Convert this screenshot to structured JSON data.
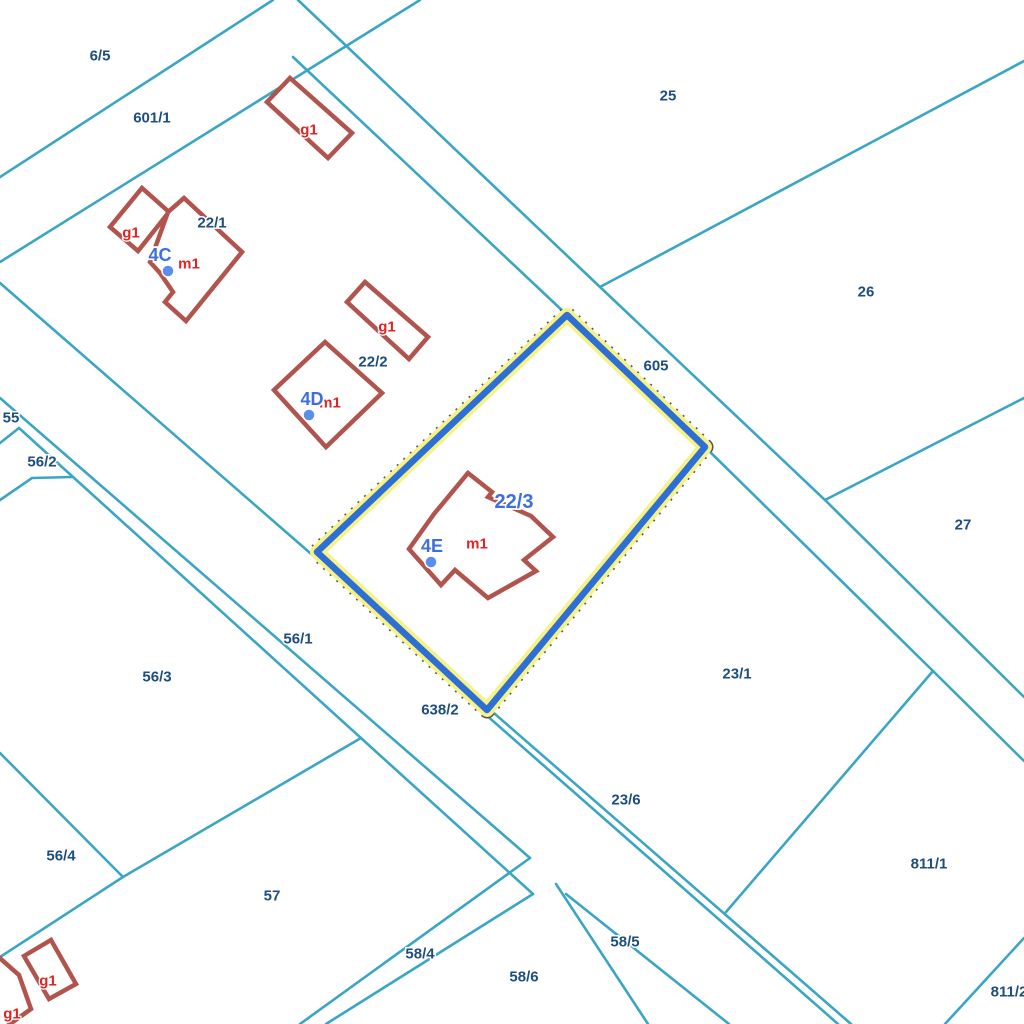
{
  "map": {
    "background": "#ffffff",
    "colors": {
      "parcel_line": "#3ba6c4",
      "building_stroke": "#b2544e",
      "building_fill": "#ffffff",
      "label_navy": "#1d4e7e",
      "label_red": "#e02424",
      "label_blue": "#3f6fdd",
      "highlight_blue": "#2e6fd6",
      "highlight_halo": "#f7f287",
      "highlight_dash": "#555555",
      "address_dot": "#5b8cf0"
    },
    "highlight": {
      "parcel_id": "22/3",
      "points": [
        [
          567,
          315
        ],
        [
          705,
          447
        ],
        [
          487,
          710
        ],
        [
          317,
          552
        ]
      ]
    },
    "boundary_lines": [
      {
        "id": "l1",
        "points": [
          [
            0,
            177
          ],
          [
            273,
            0
          ]
        ]
      },
      {
        "id": "l2",
        "points": [
          [
            0,
            262
          ],
          [
            420,
            0
          ]
        ]
      },
      {
        "id": "l3",
        "points": [
          [
            0,
            283
          ],
          [
            851,
            1024
          ]
        ]
      },
      {
        "id": "r1",
        "points": [
          [
            293,
            57
          ],
          [
            567,
            315
          ],
          [
            705,
            447
          ],
          [
            933,
            671
          ],
          [
            1024,
            761
          ]
        ]
      },
      {
        "id": "r2",
        "points": [
          [
            298,
            0
          ],
          [
            600,
            287
          ],
          [
            825,
            500
          ],
          [
            1024,
            697
          ]
        ]
      },
      {
        "id": "t25",
        "points": [
          [
            600,
            287
          ],
          [
            1024,
            61
          ]
        ]
      },
      {
        "id": "t26",
        "points": [
          [
            825,
            500
          ],
          [
            1024,
            398
          ]
        ]
      },
      {
        "id": "t23",
        "points": [
          [
            933,
            671
          ],
          [
            726,
            912
          ]
        ]
      },
      {
        "id": "t811",
        "points": [
          [
            1024,
            938
          ],
          [
            945,
            1024
          ]
        ]
      },
      {
        "id": "w1",
        "points": [
          [
            0,
            398
          ],
          [
            530,
            858
          ]
        ]
      },
      {
        "id": "w2",
        "points": [
          [
            19,
            428
          ],
          [
            533,
            894
          ]
        ]
      },
      {
        "id": "b55",
        "points": [
          [
            0,
            443
          ],
          [
            19,
            428
          ]
        ]
      },
      {
        "id": "pocket562",
        "points": [
          [
            0,
            500
          ],
          [
            32,
            478
          ],
          [
            72,
            477
          ]
        ]
      },
      {
        "id": "s563",
        "points": [
          [
            0,
            753
          ],
          [
            123,
            877
          ]
        ]
      },
      {
        "id": "s564",
        "points": [
          [
            0,
            957
          ],
          [
            123,
            877
          ],
          [
            361,
            738
          ]
        ]
      },
      {
        "id": "f1",
        "points": [
          [
            530,
            858
          ],
          [
            300,
            1024
          ]
        ]
      },
      {
        "id": "f2",
        "points": [
          [
            533,
            894
          ],
          [
            326,
            1024
          ]
        ]
      },
      {
        "id": "f3",
        "points": [
          [
            556,
            884
          ],
          [
            648,
            1024
          ]
        ]
      },
      {
        "id": "f4",
        "points": [
          [
            566,
            894
          ],
          [
            729,
            1024
          ]
        ]
      },
      {
        "id": "d2",
        "points": [
          [
            485,
            714
          ],
          [
            838,
            1024
          ]
        ]
      }
    ],
    "buildings": [
      {
        "id": "g1-top",
        "points": [
          [
            290,
            78
          ],
          [
            352,
            133
          ],
          [
            328,
            158
          ],
          [
            267,
            102
          ]
        ]
      },
      {
        "id": "g1-22-1",
        "points": [
          [
            142,
            188
          ],
          [
            169,
            212
          ],
          [
            138,
            251
          ],
          [
            110,
            227
          ]
        ]
      },
      {
        "id": "m1-22-1",
        "points": [
          [
            184,
            198
          ],
          [
            242,
            252
          ],
          [
            186,
            321
          ],
          [
            165,
            302
          ],
          [
            173,
            292
          ],
          [
            160,
            273
          ],
          [
            150,
            262
          ],
          [
            168,
            212
          ]
        ]
      },
      {
        "id": "g1-22-2",
        "points": [
          [
            365,
            282
          ],
          [
            428,
            337
          ],
          [
            409,
            359
          ],
          [
            347,
            302
          ]
        ]
      },
      {
        "id": "m1-22-2",
        "points": [
          [
            325,
            342
          ],
          [
            382,
            393
          ],
          [
            326,
            447
          ],
          [
            274,
            390
          ]
        ]
      },
      {
        "id": "m1-22-3",
        "points": [
          [
            468,
            473
          ],
          [
            492,
            492
          ],
          [
            488,
            497
          ],
          [
            531,
            516
          ],
          [
            553,
            537
          ],
          [
            524,
            560
          ],
          [
            536,
            571
          ],
          [
            488,
            598
          ],
          [
            455,
            570
          ],
          [
            441,
            585
          ],
          [
            409,
            549
          ],
          [
            434,
            514
          ]
        ]
      },
      {
        "id": "g1-bottom-right",
        "points": [
          [
            51,
            940
          ],
          [
            76,
            984
          ],
          [
            49,
            999
          ],
          [
            24,
            956
          ]
        ]
      },
      {
        "id": "g1-bottom-left",
        "points": [
          [
            -14,
            946
          ],
          [
            19,
            975
          ],
          [
            31,
            1009
          ],
          [
            -4,
            1034
          ]
        ]
      }
    ],
    "address_points": [
      {
        "label": "4C",
        "label_x": 160,
        "label_y": 255,
        "dot_x": 168,
        "dot_y": 271
      },
      {
        "label": "4D",
        "label_x": 312,
        "label_y": 399,
        "dot_x": 309,
        "dot_y": 415
      },
      {
        "label": "4E",
        "label_x": 432,
        "label_y": 546,
        "dot_x": 431,
        "dot_y": 562
      }
    ],
    "labels": [
      {
        "text": "6/5",
        "x": 100,
        "y": 56,
        "kind": "parcel"
      },
      {
        "text": "601/1",
        "x": 152,
        "y": 118,
        "kind": "parcel"
      },
      {
        "text": "25",
        "x": 668,
        "y": 96,
        "kind": "parcel"
      },
      {
        "text": "26",
        "x": 866,
        "y": 292,
        "kind": "parcel"
      },
      {
        "text": "27",
        "x": 963,
        "y": 525,
        "kind": "parcel"
      },
      {
        "text": "605",
        "x": 656,
        "y": 366,
        "kind": "parcel"
      },
      {
        "text": "22/1",
        "x": 212,
        "y": 223,
        "kind": "parcel"
      },
      {
        "text": "22/2",
        "x": 373,
        "y": 362,
        "kind": "parcel"
      },
      {
        "text": "22/3",
        "x": 514,
        "y": 502,
        "kind": "blue-parcel"
      },
      {
        "text": "55",
        "x": 11,
        "y": 418,
        "kind": "parcel"
      },
      {
        "text": "56/2",
        "x": 42,
        "y": 462,
        "kind": "parcel"
      },
      {
        "text": "56/1",
        "x": 298,
        "y": 639,
        "kind": "parcel"
      },
      {
        "text": "56/3",
        "x": 157,
        "y": 677,
        "kind": "parcel"
      },
      {
        "text": "56/4",
        "x": 61,
        "y": 856,
        "kind": "parcel"
      },
      {
        "text": "57",
        "x": 272,
        "y": 896,
        "kind": "parcel"
      },
      {
        "text": "638/2",
        "x": 440,
        "y": 710,
        "kind": "parcel"
      },
      {
        "text": "23/1",
        "x": 737,
        "y": 674,
        "kind": "parcel"
      },
      {
        "text": "23/6",
        "x": 626,
        "y": 800,
        "kind": "parcel"
      },
      {
        "text": "58/4",
        "x": 420,
        "y": 954,
        "kind": "parcel"
      },
      {
        "text": "58/6",
        "x": 524,
        "y": 977,
        "kind": "parcel"
      },
      {
        "text": "58/5",
        "x": 625,
        "y": 942,
        "kind": "parcel"
      },
      {
        "text": "811/1",
        "x": 929,
        "y": 864,
        "kind": "parcel"
      },
      {
        "text": "811/2",
        "x": 1009,
        "y": 992,
        "kind": "parcel"
      },
      {
        "text": "g1",
        "x": 309,
        "y": 130,
        "kind": "red"
      },
      {
        "text": "g1",
        "x": 131,
        "y": 233,
        "kind": "red"
      },
      {
        "text": "m1",
        "x": 189,
        "y": 264,
        "kind": "red"
      },
      {
        "text": "g1",
        "x": 387,
        "y": 327,
        "kind": "red"
      },
      {
        "text": "m1",
        "x": 330,
        "y": 403,
        "kind": "red"
      },
      {
        "text": "m1",
        "x": 477,
        "y": 544,
        "kind": "red"
      },
      {
        "text": "g1",
        "x": 48,
        "y": 981,
        "kind": "red"
      },
      {
        "text": "g1",
        "x": 12,
        "y": 1014,
        "kind": "red"
      }
    ]
  }
}
